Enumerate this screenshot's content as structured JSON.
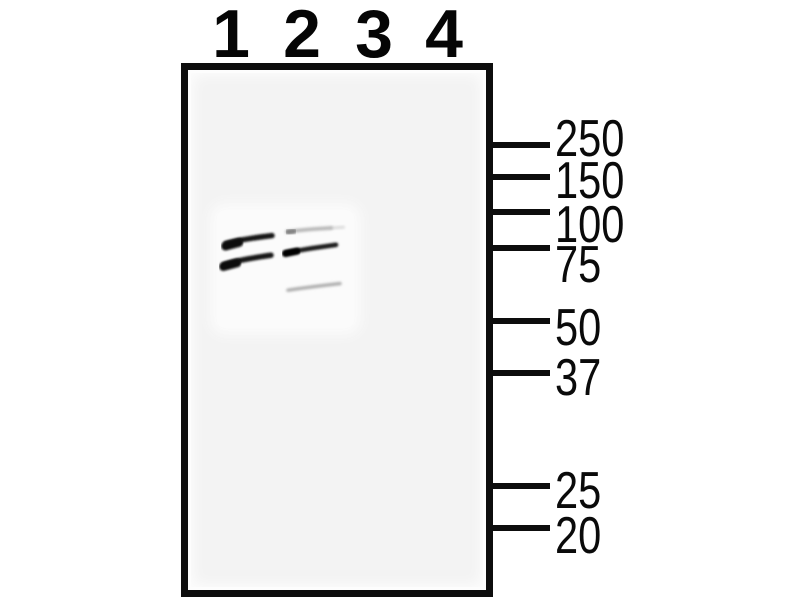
{
  "figure": {
    "kind": "western-blot",
    "lane_labels": [
      "1",
      "2",
      "3",
      "4"
    ],
    "mw_marker_labels": [
      "250",
      "150",
      "100",
      "75",
      "50",
      "37",
      "25",
      "20"
    ]
  },
  "chart_data": {
    "type": "western_blot",
    "lanes": [
      "1",
      "2",
      "3",
      "4"
    ],
    "mw_markers": [
      250,
      150,
      100,
      75,
      50,
      37,
      25,
      20
    ],
    "bands": [
      {
        "lane": "1",
        "approx_kda": 80,
        "intensity": "strong"
      },
      {
        "lane": "1",
        "approx_kda": 70,
        "intensity": "strong"
      },
      {
        "lane": "2",
        "approx_kda": 87,
        "intensity": "faint"
      },
      {
        "lane": "2",
        "approx_kda": 75,
        "intensity": "strong"
      },
      {
        "lane": "2",
        "approx_kda": 61,
        "intensity": "faint"
      }
    ],
    "empty_lanes": [
      "3",
      "4"
    ],
    "legend_position": "none",
    "grid": false
  },
  "colors": {
    "background": "#ffffff",
    "membrane": "#f3f3f3",
    "membrane_patch": "#fbfbfb",
    "ink": "#0d0d0d",
    "strong_band": "#161616",
    "faint_band": "#a6a6a6"
  }
}
